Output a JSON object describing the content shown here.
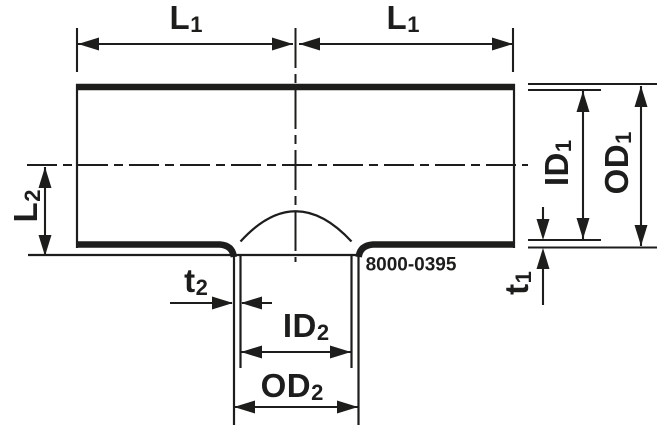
{
  "drawing": {
    "title": "tee-fitting-cross-section",
    "part_number": "8000-0395",
    "dimension_labels": {
      "l1_left": {
        "main": "L",
        "sub": "1"
      },
      "l1_right": {
        "main": "L",
        "sub": "1"
      },
      "l2": {
        "main": "L",
        "sub": "2"
      },
      "t2": {
        "main": "t",
        "sub": "2"
      },
      "id2": {
        "main": "ID",
        "sub": "2"
      },
      "od2": {
        "main": "OD",
        "sub": "2"
      },
      "id1": {
        "main": "ID",
        "sub": "1"
      },
      "od1": {
        "main": "OD",
        "sub": "1"
      },
      "t1": {
        "main": "t",
        "sub": "1"
      }
    },
    "colors": {
      "line": "#1d1d1b",
      "background": "#ffffff"
    }
  }
}
